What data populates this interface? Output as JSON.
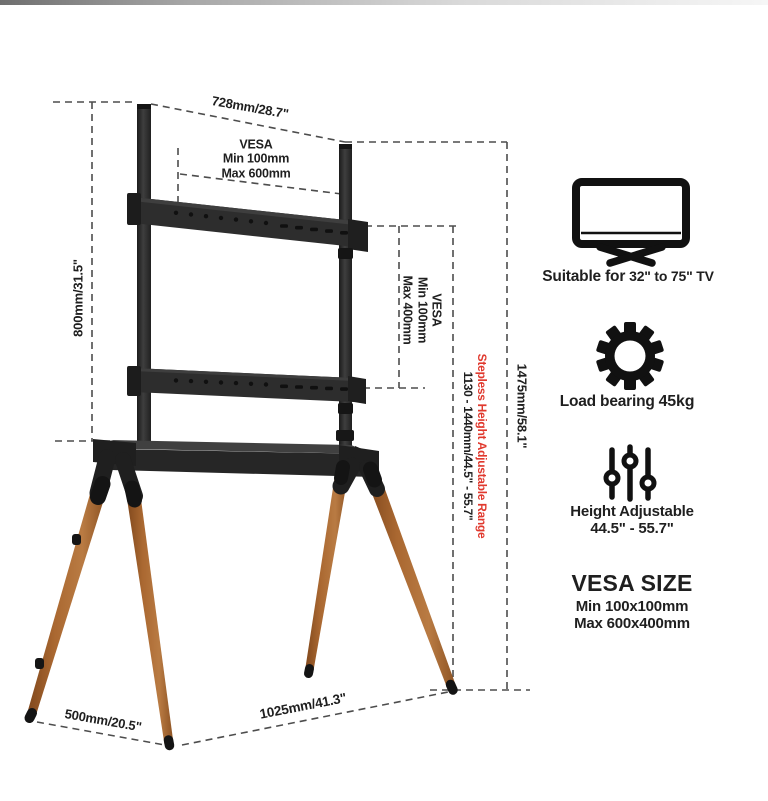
{
  "dimensions": {
    "top_width": "728mm/28.7\"",
    "pole_height": "800mm/31.5\"",
    "total_height": "1475mm/58.1\"",
    "base_depth": "500mm/20.5\"",
    "base_width": "1025mm/41.3\"",
    "vesa_top": {
      "line1": "VESA",
      "line2": "Min 100mm",
      "line3": "Max 600mm"
    },
    "vesa_mid": {
      "line1": "VESA",
      "line2": "Min 100mm",
      "line3": "Max 400mm"
    },
    "stepless": {
      "title": "Stepless Height Adjustable Range",
      "range": "1130 - 1440mm/44.5\" - 55.7\"",
      "accent_color": "#e0392e"
    }
  },
  "features": {
    "tv": {
      "icon": "tv-icon",
      "label_a": "Suitable for",
      "label_b": "32\" to 75\" TV"
    },
    "load": {
      "icon": "gear-icon",
      "label_a": "Load bearing",
      "label_b": "45kg"
    },
    "height": {
      "icon": "sliders-icon",
      "label_a": "Height Adjustable",
      "label_b": "44.5\" - 55.7\""
    }
  },
  "vesa_size": {
    "title": "VESA SIZE",
    "min": "Min 100x100mm",
    "max": "Max 600x400mm"
  },
  "colors": {
    "metal": "#2d2d2d",
    "wood": "#aa6831",
    "dash": "#4d4d4d",
    "background": "#ffffff"
  }
}
